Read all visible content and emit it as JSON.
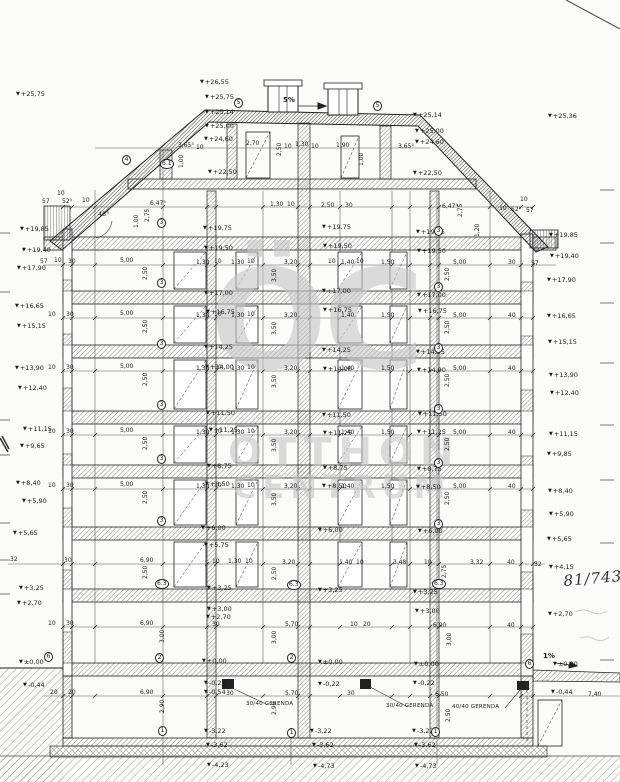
{
  "watermark": {
    "monogram": "ÖC",
    "line1": "OTTHON",
    "line2": "CENTRUM"
  },
  "levels": {
    "left": [
      [
        "+25,75",
        16,
        91
      ],
      [
        "+19,85",
        20,
        226
      ],
      [
        "+19,40",
        22,
        247
      ],
      [
        "+17,90",
        17,
        265
      ],
      [
        "+16,65",
        15,
        303
      ],
      [
        "+15,15",
        17,
        323
      ],
      [
        "+13,90",
        15,
        365
      ],
      [
        "+12,40",
        18,
        385
      ],
      [
        "+11,15",
        23,
        426
      ],
      [
        "+9,65",
        20,
        443
      ],
      [
        "+8,40",
        16,
        480
      ],
      [
        "+5,90",
        22,
        498
      ],
      [
        "+5,65",
        13,
        530
      ],
      [
        "+3,25",
        19,
        585
      ],
      [
        "+2,70",
        17,
        600
      ],
      [
        "±0,00",
        19,
        659
      ],
      [
        "-0,44",
        23,
        682
      ]
    ],
    "right": [
      [
        "+25,36",
        548,
        113
      ],
      [
        "+19,85",
        549,
        232
      ],
      [
        "+19,40",
        550,
        253
      ],
      [
        "+17,90",
        547,
        277
      ],
      [
        "+16,65",
        547,
        313
      ],
      [
        "+15,15",
        548,
        339
      ],
      [
        "+13,90",
        549,
        372
      ],
      [
        "+12,40",
        550,
        390
      ],
      [
        "+11,15",
        549,
        431
      ],
      [
        "+9,85",
        547,
        451
      ],
      [
        "+8,40",
        548,
        488
      ],
      [
        "+5,90",
        549,
        511
      ],
      [
        "+5,65",
        547,
        536
      ],
      [
        "+4,15",
        549,
        564
      ],
      [
        "+2,70",
        548,
        611
      ]
    ],
    "interior": [
      [
        "+26,55",
        200,
        79
      ],
      [
        "+25,75",
        205,
        94
      ],
      [
        "+25,14",
        205,
        109
      ],
      [
        "+25,00",
        205,
        123
      ],
      [
        "+24,60",
        204,
        136
      ],
      [
        "+22,50",
        208,
        169
      ],
      [
        "+25,14",
        413,
        112
      ],
      [
        "+25,00",
        415,
        128
      ],
      [
        "+24,60",
        415,
        139
      ],
      [
        "+22,50",
        413,
        170
      ],
      [
        "+19,75",
        203,
        225
      ],
      [
        "+19,50",
        204,
        245
      ],
      [
        "+19,75",
        322,
        224
      ],
      [
        "+19,50",
        323,
        243
      ],
      [
        "+19,75",
        416,
        229
      ],
      [
        "+19,50",
        417,
        248
      ],
      [
        "+17,00",
        204,
        290
      ],
      [
        "+16,75",
        206,
        309
      ],
      [
        "+17,00",
        322,
        288
      ],
      [
        "+16,75",
        323,
        307
      ],
      [
        "+17,00",
        417,
        292
      ],
      [
        "+16,75",
        418,
        308
      ],
      [
        "+14,25",
        204,
        344
      ],
      [
        "+14,00",
        205,
        364
      ],
      [
        "+14,25",
        322,
        347
      ],
      [
        "+14,00",
        323,
        366
      ],
      [
        "+14,25",
        416,
        349
      ],
      [
        "+14,00",
        417,
        367
      ],
      [
        "+11,50",
        206,
        410
      ],
      [
        "+11,25",
        209,
        427
      ],
      [
        "+11,50",
        322,
        412
      ],
      [
        "+11,25",
        323,
        430
      ],
      [
        "+11,50",
        418,
        411
      ],
      [
        "+11,25",
        417,
        429
      ],
      [
        "+8,75",
        207,
        463
      ],
      [
        "+8,50",
        205,
        481
      ],
      [
        "+8,75",
        323,
        465
      ],
      [
        "+8,50",
        322,
        483
      ],
      [
        "+8,75",
        417,
        466
      ],
      [
        "+8,50",
        416,
        484
      ],
      [
        "+6,00",
        201,
        525
      ],
      [
        "+5,75",
        204,
        542
      ],
      [
        "+6,00",
        318,
        527
      ],
      [
        "+6,00",
        418,
        528
      ],
      [
        "+3,25",
        207,
        585
      ],
      [
        "+3,00",
        207,
        606
      ],
      [
        "+2,70",
        206,
        614
      ],
      [
        "+3,25",
        318,
        587
      ],
      [
        "+3,25",
        413,
        589
      ],
      [
        "+3,00",
        415,
        608
      ],
      [
        "±0,00",
        202,
        658
      ],
      [
        "-0,22",
        204,
        680
      ],
      [
        "-0,54",
        204,
        689
      ],
      [
        "±0,00",
        318,
        659
      ],
      [
        "-0,22",
        318,
        681
      ],
      [
        "±0,00",
        414,
        661
      ],
      [
        "-0,22",
        413,
        680
      ],
      [
        "±0,00",
        553,
        661
      ],
      [
        "-0,44",
        551,
        689
      ],
      [
        "-3,22",
        204,
        728
      ],
      [
        "-3,62",
        206,
        742
      ],
      [
        "-4,23",
        207,
        762
      ],
      [
        "-3,22",
        310,
        728
      ],
      [
        "-3,62",
        312,
        742
      ],
      [
        "-4,73",
        313,
        763
      ],
      [
        "-3,22",
        412,
        728
      ],
      [
        "-3,62",
        414,
        742
      ],
      [
        "-4,73",
        415,
        763
      ]
    ]
  },
  "dims": [
    [
      178,
      143,
      "3,65⁵"
    ],
    [
      196,
      145,
      "10"
    ],
    [
      246,
      141,
      "2,70"
    ],
    [
      284,
      144,
      "10"
    ],
    [
      295,
      142,
      "1,30"
    ],
    [
      311,
      144,
      "10"
    ],
    [
      336,
      143,
      "1,90"
    ],
    [
      398,
      144,
      "3,65⁵"
    ],
    [
      42,
      199,
      "57"
    ],
    [
      62,
      199,
      "52⁵"
    ],
    [
      82,
      198,
      "10"
    ],
    [
      57,
      191,
      "10"
    ],
    [
      150,
      201,
      "6,47⁵"
    ],
    [
      270,
      202,
      "1,30"
    ],
    [
      287,
      202,
      "10"
    ],
    [
      321,
      203,
      "2,50"
    ],
    [
      345,
      203,
      "30"
    ],
    [
      442,
      204,
      "6,47⁵"
    ],
    [
      499,
      206,
      "10"
    ],
    [
      511,
      207,
      "52⁵"
    ],
    [
      526,
      208,
      "57"
    ],
    [
      520,
      197,
      "10"
    ],
    [
      40,
      259,
      "57"
    ],
    [
      54,
      258,
      "10"
    ],
    [
      68,
      259,
      "30"
    ],
    [
      120,
      258,
      "5,00"
    ],
    [
      196,
      260,
      "1,30"
    ],
    [
      214,
      259,
      "10"
    ],
    [
      231,
      260,
      "1,30"
    ],
    [
      247,
      259,
      "10"
    ],
    [
      284,
      260,
      "3,20"
    ],
    [
      328,
      259,
      "10"
    ],
    [
      341,
      260,
      "1,40"
    ],
    [
      356,
      259,
      "10"
    ],
    [
      381,
      260,
      "1,50"
    ],
    [
      453,
      260,
      "5,00"
    ],
    [
      508,
      260,
      "30"
    ],
    [
      531,
      261,
      "57"
    ],
    [
      48,
      312,
      "10"
    ],
    [
      66,
      312,
      "30"
    ],
    [
      120,
      311,
      "5,00"
    ],
    [
      196,
      313,
      "1,30"
    ],
    [
      214,
      312,
      "10"
    ],
    [
      231,
      313,
      "1,30"
    ],
    [
      247,
      312,
      "10"
    ],
    [
      284,
      313,
      "3,20"
    ],
    [
      341,
      313,
      "1,40"
    ],
    [
      381,
      313,
      "1,50"
    ],
    [
      453,
      313,
      "5,00"
    ],
    [
      508,
      313,
      "40"
    ],
    [
      48,
      365,
      "10"
    ],
    [
      66,
      365,
      "30"
    ],
    [
      120,
      364,
      "5,00"
    ],
    [
      196,
      366,
      "1,30"
    ],
    [
      214,
      365,
      "10"
    ],
    [
      231,
      366,
      "1,30"
    ],
    [
      247,
      365,
      "10"
    ],
    [
      284,
      366,
      "3,20"
    ],
    [
      341,
      366,
      "1,40"
    ],
    [
      381,
      366,
      "1,50"
    ],
    [
      453,
      366,
      "5,00"
    ],
    [
      508,
      366,
      "40"
    ],
    [
      48,
      429,
      "10"
    ],
    [
      66,
      429,
      "30"
    ],
    [
      120,
      428,
      "5,00"
    ],
    [
      196,
      430,
      "1,30"
    ],
    [
      214,
      429,
      "10"
    ],
    [
      231,
      430,
      "1,30"
    ],
    [
      247,
      429,
      "10"
    ],
    [
      284,
      430,
      "3,20"
    ],
    [
      341,
      430,
      "1,40"
    ],
    [
      381,
      430,
      "1,50"
    ],
    [
      453,
      430,
      "5,00"
    ],
    [
      508,
      430,
      "40"
    ],
    [
      48,
      483,
      "10"
    ],
    [
      66,
      483,
      "30"
    ],
    [
      120,
      482,
      "5,00"
    ],
    [
      196,
      484,
      "1,30"
    ],
    [
      214,
      483,
      "10"
    ],
    [
      231,
      484,
      "1,30"
    ],
    [
      247,
      483,
      "10"
    ],
    [
      284,
      484,
      "3,20"
    ],
    [
      341,
      484,
      "1,40"
    ],
    [
      381,
      484,
      "1,50"
    ],
    [
      453,
      484,
      "5,00"
    ],
    [
      508,
      484,
      "40"
    ],
    [
      10,
      557,
      "32"
    ],
    [
      64,
      558,
      "30"
    ],
    [
      140,
      558,
      "6,90"
    ],
    [
      212,
      559,
      "10"
    ],
    [
      228,
      559,
      "1,30"
    ],
    [
      245,
      559,
      "10"
    ],
    [
      282,
      560,
      "3,20"
    ],
    [
      339,
      560,
      "1,40"
    ],
    [
      356,
      560,
      "10"
    ],
    [
      393,
      560,
      "3,48"
    ],
    [
      424,
      560,
      "10"
    ],
    [
      470,
      560,
      "3,32"
    ],
    [
      507,
      560,
      "40"
    ],
    [
      534,
      562,
      "32"
    ],
    [
      48,
      621,
      "10"
    ],
    [
      66,
      621,
      "30"
    ],
    [
      140,
      621,
      "6,90"
    ],
    [
      212,
      622,
      "30"
    ],
    [
      285,
      622,
      "5,70"
    ],
    [
      350,
      622,
      "10"
    ],
    [
      363,
      622,
      "20"
    ],
    [
      433,
      623,
      "6,90"
    ],
    [
      507,
      623,
      "40"
    ],
    [
      50,
      690,
      "20"
    ],
    [
      68,
      690,
      "20"
    ],
    [
      140,
      690,
      "6,90"
    ],
    [
      226,
      691,
      "30"
    ],
    [
      285,
      691,
      "5,70"
    ],
    [
      347,
      691,
      "30"
    ],
    [
      435,
      692,
      "6,50"
    ],
    [
      588,
      692,
      "7,40"
    ]
  ],
  "vdims": [
    [
      277,
      156,
      "2,50"
    ],
    [
      145,
      222,
      "2,75"
    ],
    [
      134,
      228,
      "1,00"
    ],
    [
      458,
      217,
      "2,75"
    ],
    [
      475,
      237,
      "1,20"
    ],
    [
      179,
      168,
      "1,00"
    ],
    [
      359,
      166,
      "1,00"
    ],
    [
      143,
      280,
      "2,50"
    ],
    [
      272,
      282,
      "3,50"
    ],
    [
      445,
      281,
      "2,50"
    ],
    [
      143,
      333,
      "2,50"
    ],
    [
      272,
      335,
      "3,50"
    ],
    [
      445,
      334,
      "2,50"
    ],
    [
      143,
      386,
      "2,50"
    ],
    [
      272,
      388,
      "3,50"
    ],
    [
      445,
      387,
      "2,50"
    ],
    [
      143,
      450,
      "2,50"
    ],
    [
      272,
      452,
      "3,50"
    ],
    [
      445,
      451,
      "2,50"
    ],
    [
      143,
      504,
      "2,50"
    ],
    [
      272,
      506,
      "3,50"
    ],
    [
      445,
      505,
      "2,50"
    ],
    [
      143,
      579,
      "2,50"
    ],
    [
      272,
      580,
      "2,50"
    ],
    [
      442,
      578,
      "2,75"
    ],
    [
      160,
      643,
      "3,00"
    ],
    [
      272,
      644,
      "3,00"
    ],
    [
      447,
      646,
      "3,00"
    ],
    [
      160,
      713,
      "2,90"
    ],
    [
      272,
      715,
      "2,90"
    ],
    [
      446,
      722,
      "2,50"
    ]
  ],
  "axis_bubbles": [
    [
      122,
      155,
      "4"
    ],
    [
      160,
      159,
      "6.1"
    ],
    [
      234,
      98,
      "5"
    ],
    [
      373,
      101,
      "5"
    ],
    [
      157,
      218,
      "3"
    ],
    [
      434,
      226,
      "3"
    ],
    [
      157,
      278,
      "3"
    ],
    [
      434,
      282,
      "3"
    ],
    [
      157,
      339,
      "3"
    ],
    [
      434,
      343,
      "3"
    ],
    [
      157,
      400,
      "3"
    ],
    [
      434,
      404,
      "3"
    ],
    [
      157,
      454,
      "3"
    ],
    [
      434,
      458,
      "3"
    ],
    [
      157,
      516,
      "3"
    ],
    [
      434,
      519,
      "3"
    ],
    [
      155,
      579,
      "6.3"
    ],
    [
      287,
      580,
      "6.3"
    ],
    [
      432,
      579,
      "6.3"
    ],
    [
      155,
      653,
      "2"
    ],
    [
      287,
      653,
      "2"
    ],
    [
      44,
      652,
      "6"
    ],
    [
      525,
      659,
      "6"
    ],
    [
      158,
      726,
      "1"
    ],
    [
      287,
      728,
      "1"
    ],
    [
      431,
      727,
      "1"
    ]
  ],
  "notes": {
    "beam1": {
      "text": "30/40 GERENDA",
      "x": 246,
      "y": 702
    },
    "beam2": {
      "text": "30/40 GERENDA",
      "x": 386,
      "y": 704
    },
    "beam3": {
      "text": "40/40 GERENDA",
      "x": 452,
      "y": 705
    },
    "roof_slope": {
      "text": "5%",
      "x": 283,
      "y": 97
    },
    "walk_slope": {
      "text": "1%",
      "x": 543,
      "y": 653
    },
    "roof_angle": {
      "text": "45°",
      "x": 98,
      "y": 211
    },
    "handwritten": {
      "text": "81/743/2",
      "x": 563,
      "y": 574
    }
  },
  "line_color": "#222222",
  "watermark_color": "#c7c7c7"
}
